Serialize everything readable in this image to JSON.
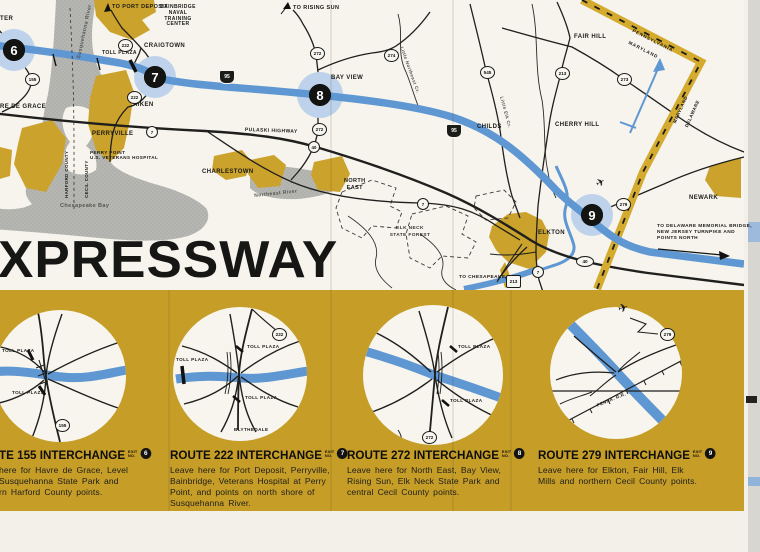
{
  "title": "XPRESSWAY",
  "colors": {
    "gold": "#c59d27",
    "expressway_blue": "#5f97d3",
    "halo_blue": "#bed3eb",
    "water_grey": "#b6b7b3",
    "paper": "#f2f0e8",
    "ink": "#1b1b18"
  },
  "map": {
    "towns": {
      "ter": "TER",
      "havre": "RE DE GRACE",
      "craigtown": "CRAIGTOWN",
      "aiken": "AIKEN",
      "perryville": "PERRYVILLE",
      "perry_point": "PERRY POINT\nU.S. VETERANS HOSPITAL",
      "charlestown": "CHARLESTOWN",
      "north_east": "NORTH\nEAST",
      "bay_view": "BAY VIEW",
      "childs": "CHILDS",
      "cherry_hill": "CHERRY HILL",
      "fair_hill": "FAIR HILL",
      "newark": "NEWARK",
      "elkton": "ELKTON",
      "blythedale": "BLYTHEDALE"
    },
    "signs": {
      "port_deposit": "TO PORT DEPOSIT",
      "rising_sun": "TO RISING SUN",
      "bainbridge": "BAINBRIDGE\nNAVAL TRAINING\nCENTER",
      "delaware": "TO DELAWARE MEMORIAL BRIDGE,\nNEW JERSEY TURNPIKE AND\nPOINTS NORTH",
      "chesapeake_city": "TO CHESAPEAKE CITY"
    },
    "waters": {
      "susquehanna": "Susquehanna River",
      "chesapeake": "Chesapeake Bay",
      "northeast_river": "Northeast River",
      "little_northeast": "Little Northeast Cr.",
      "little_elk": "Little Elk Cr."
    },
    "regions": {
      "harford": "HARFORD COUNTY",
      "cecil": "CECIL COUNTY",
      "pennsylvania": "PENNSYLVANIA",
      "maryland": "MARYLAND",
      "delaware": "DELAWARE",
      "elk_neck": "ELK NECK\nSTATE FOREST"
    },
    "labels": {
      "toll_plaza": "TOLL PLAZA",
      "pulaski": "PULASKI HIGHWAY",
      "penna_rr": "PENNA. R.R."
    },
    "shields": {
      "s155": "155",
      "s222": "222",
      "s272": "272",
      "s274": "274",
      "s545": "545",
      "s213": "213",
      "s273": "273",
      "s279": "279",
      "s40": "40",
      "s7": "7",
      "i95": "95"
    },
    "exits": {
      "e6": "6",
      "e7": "7",
      "e8": "8",
      "e9": "9"
    }
  },
  "panels": [
    {
      "route": "TE 155 INTERCHANGE",
      "exit_label": "EXIT\nNO.",
      "exit": "6",
      "body": "here for Havre de Grace, Level\nSusquehanna State Park and\nrn Harford County points."
    },
    {
      "route": "ROUTE 222 INTERCHANGE",
      "exit_label": "EXIT\nNO.",
      "exit": "7",
      "body": "Leave here for Port Deposit, Perryville,\nBainbridge, Veterans Hospital at Perry\nPoint, and points on north shore of\nSusquehanna River."
    },
    {
      "route": "ROUTE 272 INTERCHANGE",
      "exit_label": "EXIT\nNO.",
      "exit": "8",
      "body": "Leave here for North East, Bay View,\nRising Sun, Elk Neck State Park and\ncentral Cecil County points."
    },
    {
      "route": "ROUTE 279 INTERCHANGE",
      "exit_label": "EXIT\nNO.",
      "exit": "9",
      "body": "Leave here for Elkton, Fair Hill, Elk\nMills and northern Cecil County points."
    }
  ]
}
